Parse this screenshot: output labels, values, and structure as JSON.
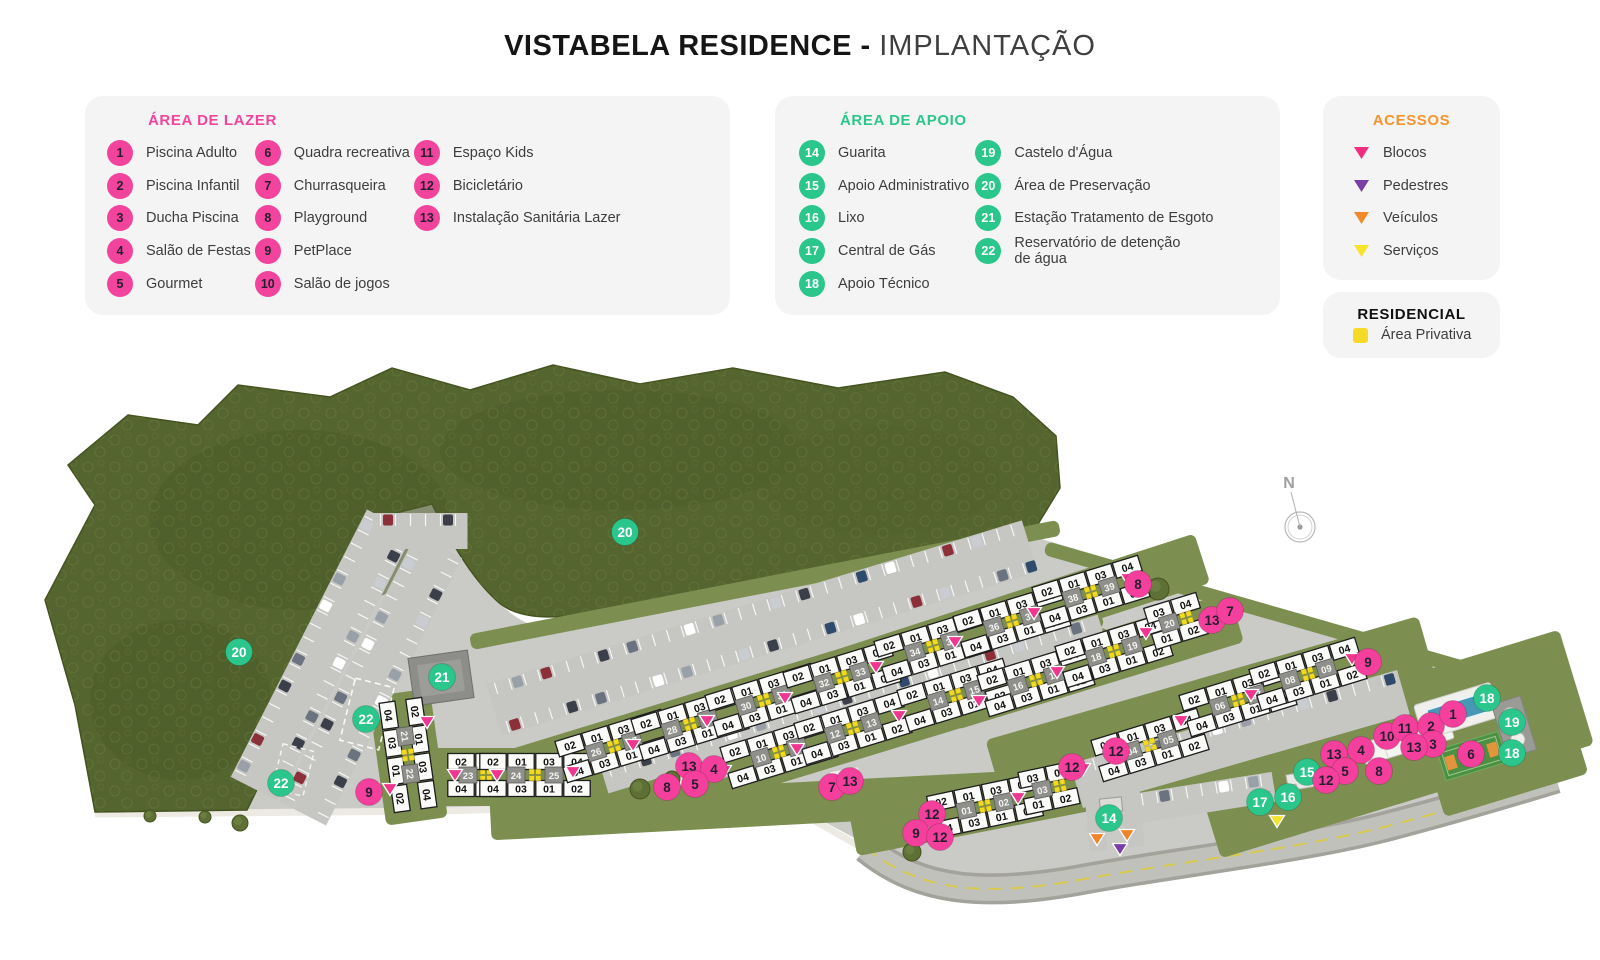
{
  "title": {
    "bold": "VISTABELA RESIDENCE -",
    "light": "IMPLANTAÇÃO"
  },
  "panels": {
    "lazer": {
      "header": "ÁREA DE LAZER",
      "accent": "#f2449c",
      "items": [
        {
          "n": "1",
          "label": "Piscina Adulto"
        },
        {
          "n": "2",
          "label": "Piscina Infantil"
        },
        {
          "n": "3",
          "label": "Ducha Piscina"
        },
        {
          "n": "4",
          "label": "Salão de Festas"
        },
        {
          "n": "5",
          "label": "Gourmet"
        },
        {
          "n": "6",
          "label": "Quadra recreativa"
        },
        {
          "n": "7",
          "label": "Churrasqueira"
        },
        {
          "n": "8",
          "label": "Playground"
        },
        {
          "n": "9",
          "label": "PetPlace"
        },
        {
          "n": "10",
          "label": "Salão de jogos"
        },
        {
          "n": "11",
          "label": "Espaço Kids"
        },
        {
          "n": "12",
          "label": "Bicicletário"
        },
        {
          "n": "13",
          "label": "Instalação Sanitária Lazer"
        }
      ]
    },
    "apoio": {
      "header": "ÁREA DE APOIO",
      "accent": "#2bc68c",
      "items": [
        {
          "n": "14",
          "label": "Guarita"
        },
        {
          "n": "15",
          "label": "Apoio Administrativo"
        },
        {
          "n": "16",
          "label": "Lixo"
        },
        {
          "n": "17",
          "label": "Central de Gás"
        },
        {
          "n": "18",
          "label": "Apoio Técnico"
        },
        {
          "n": "19",
          "label": "Castelo d'Água"
        },
        {
          "n": "20",
          "label": "Área de Preservação"
        },
        {
          "n": "21",
          "label": "Estação Tratamento de Esgoto"
        },
        {
          "n": "22",
          "label": "Reservatório de detenção\nde água"
        }
      ]
    },
    "acessos": {
      "header": "ACESSOS",
      "accent": "#f5942c",
      "items": [
        {
          "label": "Blocos",
          "color": "#ee2f80"
        },
        {
          "label": "Pedestres",
          "color": "#7a3fa5"
        },
        {
          "label": "Veículos",
          "color": "#f08a2a"
        },
        {
          "label": "Serviços",
          "color": "#f6e32b"
        }
      ]
    },
    "residencial": {
      "header": "RESIDENCIAL",
      "swatch": "#f7da28",
      "label": "Área Privativa"
    }
  },
  "map": {
    "compass_label": "N",
    "unit_top": "02 01 03 04",
    "unit_bottom": "04 03 01 02",
    "colors": {
      "L": "#f53f9d",
      "A": "#2bc68c",
      "blocos": "#f0368f",
      "pedestres": "#7b3ea8",
      "veiculos": "#f08428",
      "servicos": "#f6e32b",
      "privativa": "#f2d922"
    },
    "blocks": [
      {
        "nums": [
          "21",
          "22"
        ],
        "x": 408,
        "y": 755,
        "rot": 82
      },
      {
        "nums": [
          "23"
        ],
        "x": 475,
        "y": 775,
        "rot": 0,
        "ut": "02 01",
        "ub": "04 03"
      },
      {
        "nums": [
          "24",
          "25"
        ],
        "x": 535,
        "y": 775,
        "rot": 0
      },
      {
        "nums": [
          "26",
          "27"
        ],
        "x": 614,
        "y": 746,
        "rot": -17
      },
      {
        "nums": [
          "28",
          "29"
        ],
        "x": 690,
        "y": 724,
        "rot": -17
      },
      {
        "nums": [
          "30",
          "31"
        ],
        "x": 764,
        "y": 700,
        "rot": -17
      },
      {
        "nums": [
          "32",
          "33"
        ],
        "x": 842,
        "y": 677,
        "rot": -17
      },
      {
        "nums": [
          "34",
          "35"
        ],
        "x": 933,
        "y": 646,
        "rot": -17
      },
      {
        "nums": [
          "36",
          "37"
        ],
        "x": 1012,
        "y": 621,
        "rot": -17
      },
      {
        "nums": [
          "38",
          "39"
        ],
        "x": 1091,
        "y": 592,
        "rot": -17
      },
      {
        "nums": [
          "10",
          "11"
        ],
        "x": 779,
        "y": 752,
        "rot": -17
      },
      {
        "nums": [
          "12",
          "13"
        ],
        "x": 853,
        "y": 728,
        "rot": -17
      },
      {
        "nums": [
          "14",
          "15"
        ],
        "x": 956,
        "y": 695,
        "rot": -17
      },
      {
        "nums": [
          "16",
          "17"
        ],
        "x": 1036,
        "y": 680,
        "rot": -17
      },
      {
        "nums": [
          "18",
          "19"
        ],
        "x": 1114,
        "y": 651,
        "rot": -17
      },
      {
        "nums": [
          "20"
        ],
        "x": 1176,
        "y": 621,
        "rot": -17,
        "ut": "03 04",
        "ub": "01 02"
      },
      {
        "nums": [
          "04",
          "05"
        ],
        "x": 1150,
        "y": 745,
        "rot": -17
      },
      {
        "nums": [
          "06",
          "07"
        ],
        "x": 1238,
        "y": 700,
        "rot": -17
      },
      {
        "nums": [
          "08",
          "09"
        ],
        "x": 1308,
        "y": 674,
        "rot": -17
      },
      {
        "nums": [
          "01",
          "02"
        ],
        "x": 985,
        "y": 806,
        "rot": -12
      },
      {
        "nums": [
          "03"
        ],
        "x": 1049,
        "y": 788,
        "rot": -12,
        "ut": "03 04",
        "ub": "01 02"
      }
    ],
    "markers": [
      {
        "t": "A",
        "n": "20",
        "x": 625,
        "y": 532
      },
      {
        "t": "A",
        "n": "20",
        "x": 239,
        "y": 652
      },
      {
        "t": "A",
        "n": "21",
        "x": 442,
        "y": 677
      },
      {
        "t": "A",
        "n": "22",
        "x": 366,
        "y": 719
      },
      {
        "t": "A",
        "n": "22",
        "x": 281,
        "y": 783
      },
      {
        "t": "A",
        "n": "14",
        "x": 1109,
        "y": 818
      },
      {
        "t": "A",
        "n": "15",
        "x": 1307,
        "y": 772
      },
      {
        "t": "A",
        "n": "16",
        "x": 1288,
        "y": 797
      },
      {
        "t": "A",
        "n": "17",
        "x": 1260,
        "y": 802
      },
      {
        "t": "A",
        "n": "18",
        "x": 1487,
        "y": 698
      },
      {
        "t": "A",
        "n": "19",
        "x": 1512,
        "y": 722
      },
      {
        "t": "A",
        "n": "18",
        "x": 1512,
        "y": 753
      },
      {
        "t": "L",
        "n": "9",
        "x": 369,
        "y": 792
      },
      {
        "t": "L",
        "n": "13",
        "x": 689,
        "y": 766
      },
      {
        "t": "L",
        "n": "4",
        "x": 714,
        "y": 769
      },
      {
        "t": "L",
        "n": "8",
        "x": 667,
        "y": 787
      },
      {
        "t": "L",
        "n": "5",
        "x": 695,
        "y": 784
      },
      {
        "t": "L",
        "n": "7",
        "x": 832,
        "y": 787
      },
      {
        "t": "L",
        "n": "13",
        "x": 850,
        "y": 781
      },
      {
        "t": "L",
        "n": "8",
        "x": 1138,
        "y": 584
      },
      {
        "t": "L",
        "n": "13",
        "x": 1212,
        "y": 620
      },
      {
        "t": "L",
        "n": "7",
        "x": 1230,
        "y": 611
      },
      {
        "t": "L",
        "n": "9",
        "x": 1368,
        "y": 662
      },
      {
        "t": "L",
        "n": "12",
        "x": 1116,
        "y": 751
      },
      {
        "t": "L",
        "n": "12",
        "x": 1072,
        "y": 767
      },
      {
        "t": "L",
        "n": "12",
        "x": 932,
        "y": 814
      },
      {
        "t": "L",
        "n": "9",
        "x": 916,
        "y": 833
      },
      {
        "t": "L",
        "n": "12",
        "x": 940,
        "y": 837
      },
      {
        "t": "L",
        "n": "13",
        "x": 1334,
        "y": 754
      },
      {
        "t": "L",
        "n": "4",
        "x": 1361,
        "y": 750
      },
      {
        "t": "L",
        "n": "10",
        "x": 1387,
        "y": 736
      },
      {
        "t": "L",
        "n": "11",
        "x": 1405,
        "y": 728
      },
      {
        "t": "L",
        "n": "2",
        "x": 1431,
        "y": 726
      },
      {
        "t": "L",
        "n": "1",
        "x": 1453,
        "y": 714
      },
      {
        "t": "L",
        "n": "3",
        "x": 1433,
        "y": 744
      },
      {
        "t": "L",
        "n": "13",
        "x": 1414,
        "y": 747
      },
      {
        "t": "L",
        "n": "6",
        "x": 1471,
        "y": 754
      },
      {
        "t": "L",
        "n": "5",
        "x": 1345,
        "y": 771
      },
      {
        "t": "L",
        "n": "8",
        "x": 1379,
        "y": 771
      },
      {
        "t": "L",
        "n": "12",
        "x": 1326,
        "y": 780
      }
    ],
    "access": [
      {
        "c": "blocos",
        "x": 427,
        "y": 722
      },
      {
        "c": "blocos",
        "x": 390,
        "y": 789
      },
      {
        "c": "blocos",
        "x": 455,
        "y": 775
      },
      {
        "c": "blocos",
        "x": 497,
        "y": 775
      },
      {
        "c": "blocos",
        "x": 573,
        "y": 772
      },
      {
        "c": "blocos",
        "x": 633,
        "y": 745
      },
      {
        "c": "blocos",
        "x": 707,
        "y": 721
      },
      {
        "c": "blocos",
        "x": 785,
        "y": 698
      },
      {
        "c": "blocos",
        "x": 876,
        "y": 667
      },
      {
        "c": "blocos",
        "x": 955,
        "y": 642
      },
      {
        "c": "blocos",
        "x": 1034,
        "y": 613
      },
      {
        "c": "blocos",
        "x": 1128,
        "y": 579
      },
      {
        "c": "blocos",
        "x": 724,
        "y": 771
      },
      {
        "c": "blocos",
        "x": 797,
        "y": 749
      },
      {
        "c": "blocos",
        "x": 899,
        "y": 716
      },
      {
        "c": "blocos",
        "x": 979,
        "y": 701
      },
      {
        "c": "blocos",
        "x": 1057,
        "y": 672
      },
      {
        "c": "blocos",
        "x": 1146,
        "y": 633
      },
      {
        "c": "blocos",
        "x": 1083,
        "y": 769
      },
      {
        "c": "blocos",
        "x": 1181,
        "y": 721
      },
      {
        "c": "blocos",
        "x": 1251,
        "y": 695
      },
      {
        "c": "blocos",
        "x": 1352,
        "y": 659
      },
      {
        "c": "blocos",
        "x": 925,
        "y": 826
      },
      {
        "c": "blocos",
        "x": 1018,
        "y": 798
      },
      {
        "c": "pedestres",
        "x": 1120,
        "y": 849
      },
      {
        "c": "veiculos",
        "x": 1097,
        "y": 839
      },
      {
        "c": "veiculos",
        "x": 1127,
        "y": 835
      },
      {
        "c": "servicos",
        "x": 1277,
        "y": 821
      }
    ]
  }
}
